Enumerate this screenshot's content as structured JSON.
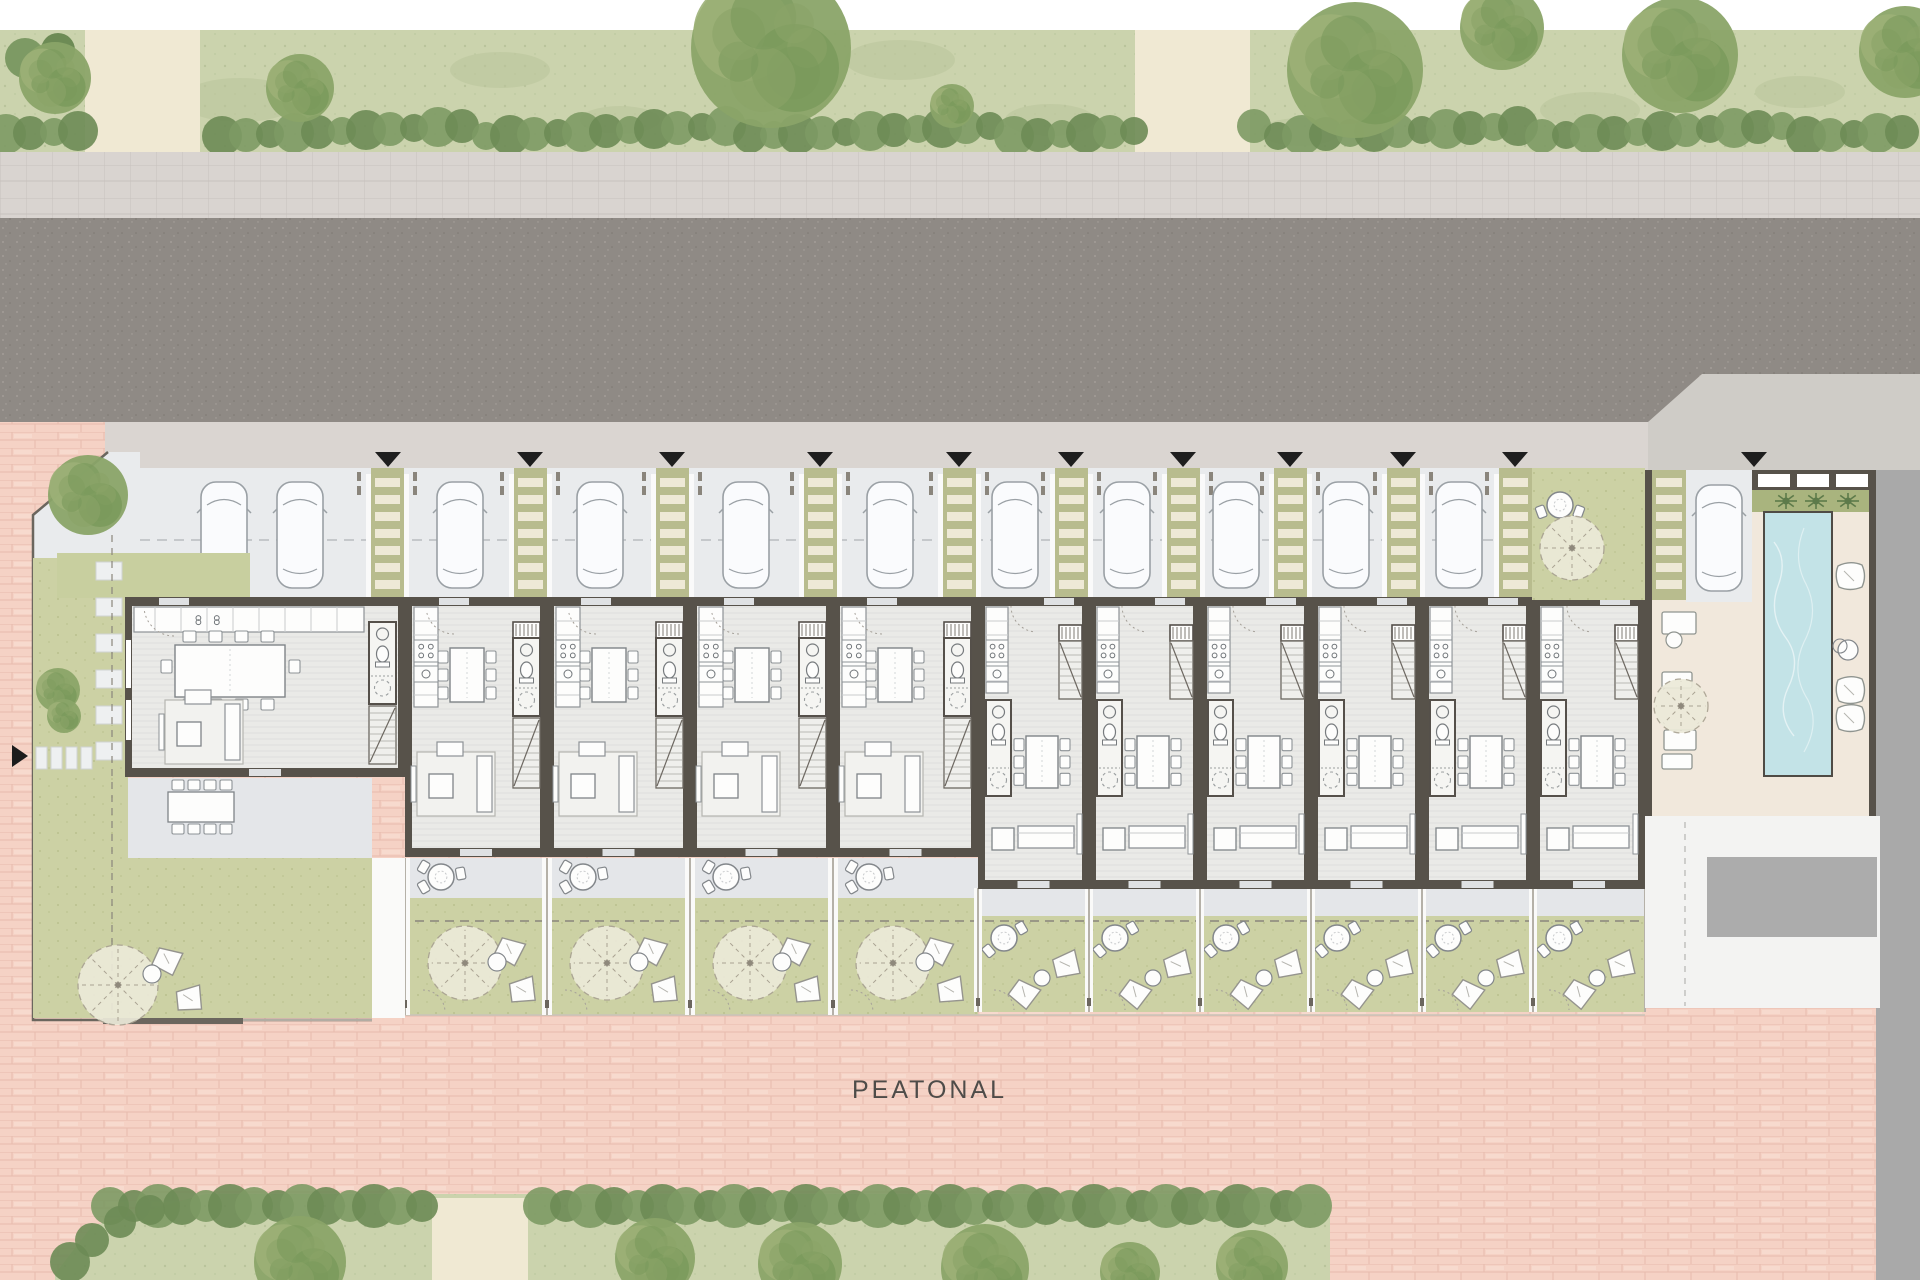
{
  "peatonal_label": "PEATONAL",
  "palette": {
    "white": "#ffffff",
    "lawn": "#cbd3ad",
    "lawn_dark": "#b9c49b",
    "hedge1": "#7d9a64",
    "hedge2": "#6d8b55",
    "tree1": "#8aa468",
    "tree2": "#7a9a5c",
    "tree3": "#9cb077",
    "beige_path": "#f0e9d3",
    "sidewalk": "#d9d4d0",
    "sidewalk_line": "#c8c2be",
    "road": "#8f8a85",
    "road_speck": "#a8a39d",
    "apron": "#cfccc7",
    "entry_band": "#dad5d1",
    "parking_bg": "#e9ebed",
    "pad_edge": "#c2c6ca",
    "strip_bg": "#b8bc8e",
    "strip_rung": "#eee9d6",
    "car_fill": "#fafbfd",
    "car_stroke": "#9aa0a5",
    "wall": "#57524a",
    "floor": "#eaeae7",
    "floor_line": "#dfdfdc",
    "fixture_stroke": "#8d9296",
    "fixture_fill": "#fdfdfc",
    "stair_fill": "#efefec",
    "terrace": "#e4e6e9",
    "garden_lawn": "#ccd1a4",
    "pink": "#f5d2c5",
    "pink_line": "#e6bbad",
    "pool": "#c3e3e7",
    "deck": "#f1e8dc",
    "planter": "#a9b47e",
    "palm": "#5d7a4a",
    "plaza": "#f3f3f2",
    "gray_block": "#acacac",
    "gray_band": "#a9a9a9",
    "label_color": "#4e4c49",
    "triangle": "#1e1e1e",
    "dash_line": "#8a857c"
  },
  "bands": {
    "lawn_top": [
      30,
      152
    ],
    "sidewalk": [
      152,
      218
    ],
    "road": [
      218,
      422
    ],
    "entry": [
      422,
      470
    ],
    "parking": [
      468,
      600
    ],
    "units_top": 597
  },
  "top_strip": {
    "beige_paths": [
      [
        85,
        115
      ],
      [
        1135,
        115
      ]
    ],
    "hedge_gaps": [
      [
        85,
        200
      ],
      [
        1135,
        1250
      ]
    ],
    "trees": [
      [
        771,
        48,
        80
      ],
      [
        300,
        88,
        34
      ],
      [
        55,
        78,
        36
      ],
      [
        1355,
        70,
        68
      ],
      [
        1502,
        28,
        42
      ],
      [
        1680,
        55,
        58
      ],
      [
        1905,
        52,
        46
      ],
      [
        952,
        106,
        22
      ]
    ],
    "grass_patches": [
      [
        240,
        100,
        60,
        22
      ],
      [
        500,
        70,
        50,
        18
      ],
      [
        620,
        120,
        40,
        14
      ],
      [
        900,
        60,
        55,
        20
      ],
      [
        1050,
        120,
        45,
        16
      ],
      [
        1300,
        132,
        40,
        14
      ],
      [
        1590,
        110,
        50,
        18
      ],
      [
        1800,
        92,
        45,
        16
      ]
    ]
  },
  "parking": {
    "x1": 140,
    "x2": 1645,
    "strips": [
      371,
      514,
      656,
      804,
      943,
      1055,
      1167,
      1274,
      1387,
      1499
    ],
    "strip_w": 33,
    "cars": [
      224,
      300,
      460,
      600,
      746,
      890,
      1015,
      1127,
      1236,
      1346,
      1459
    ],
    "car_cy": 535,
    "dash_y": 540,
    "front_garden": {
      "x": 1532,
      "w": 113
    }
  },
  "triangles": [
    388,
    530,
    672,
    820,
    959,
    1071,
    1183,
    1290,
    1403,
    1515,
    1754
  ],
  "units": {
    "top_y": 597,
    "list": [
      {
        "t": "C",
        "x": 125,
        "w": 280,
        "bottom": 768
      },
      {
        "t": "A",
        "x": 405,
        "w": 142,
        "bottom": 848
      },
      {
        "t": "A",
        "x": 547,
        "w": 143,
        "bottom": 848
      },
      {
        "t": "A",
        "x": 690,
        "w": 143,
        "bottom": 848
      },
      {
        "t": "A",
        "x": 833,
        "w": 145,
        "bottom": 848
      },
      {
        "t": "B",
        "x": 978,
        "w": 111,
        "bottom": 880
      },
      {
        "t": "B",
        "x": 1089,
        "w": 111,
        "bottom": 880
      },
      {
        "t": "B",
        "x": 1200,
        "w": 111,
        "bottom": 880
      },
      {
        "t": "B",
        "x": 1311,
        "w": 111,
        "bottom": 880
      },
      {
        "t": "B",
        "x": 1422,
        "w": 111,
        "bottom": 880
      },
      {
        "t": "B",
        "x": 1533,
        "w": 112,
        "bottom": 880
      }
    ]
  },
  "gardens": {
    "a_terrace": [
      858,
      898
    ],
    "a_lawn": [
      898,
      1015
    ],
    "b_walk": [
      888,
      916
    ],
    "b_lawn": [
      916,
      1012
    ],
    "dash_y": 921,
    "bottom_y": 1015
  },
  "left_corner": {
    "pad_poly": [
      [
        33,
        515
      ],
      [
        108,
        452
      ],
      [
        140,
        452
      ],
      [
        140,
        600
      ],
      [
        33,
        560
      ]
    ],
    "tree": [
      88,
      495,
      40
    ],
    "olive_patch": [
      57,
      553,
      193,
      45
    ],
    "lawn_col": [
      33,
      558,
      95,
      460
    ],
    "stones_col": {
      "x": 96,
      "y0": 562,
      "n": 6,
      "step": 36,
      "w": 26,
      "h": 18
    },
    "stones_row": {
      "y": 747,
      "x0": 36,
      "n": 4,
      "step": 15,
      "w": 11,
      "h": 22
    },
    "arrow": [
      12,
      745,
      28,
      756
    ],
    "terrace": [
      128,
      778,
      244,
      80
    ],
    "garden": [
      128,
      858,
      244,
      160
    ],
    "parasol": [
      118,
      985,
      40
    ],
    "small_trees": [
      [
        58,
        690,
        22
      ],
      [
        64,
        716,
        17
      ]
    ]
  },
  "amenity": {
    "x1": 1645,
    "x2": 1876,
    "wall_bottom": 816,
    "strip": [
      1652,
      470,
      34,
      130
    ],
    "pad": [
      1686,
      470,
      66,
      132
    ],
    "car_cx": 1719,
    "car_cy": 538,
    "window_wall": [
      1752,
      470,
      124,
      20
    ],
    "windows": [
      [
        1758,
        474,
        32,
        13
      ],
      [
        1797,
        474,
        32,
        13
      ],
      [
        1836,
        474,
        32,
        13
      ]
    ],
    "planter": [
      1752,
      490,
      120,
      22
    ],
    "palms": [
      [
        1786,
        501
      ],
      [
        1816,
        501
      ],
      [
        1848,
        501
      ]
    ],
    "pool": [
      1764,
      512,
      68,
      264
    ],
    "pillows_right": [
      [
        1836,
        562
      ],
      [
        1836,
        676
      ],
      [
        1836,
        704
      ]
    ],
    "side_table": [
      1848,
      650,
      10
    ],
    "loungers_left": [
      [
        1662,
        612,
        34,
        22
      ],
      [
        1662,
        672,
        30,
        16
      ],
      [
        1664,
        730,
        32,
        20
      ],
      [
        1662,
        754,
        30,
        15
      ]
    ],
    "parasol": [
      1681,
      706,
      27
    ],
    "plaza": [
      1645,
      816,
      235,
      192
    ],
    "gray_block": [
      1707,
      857,
      170,
      80
    ],
    "dash_x": 1685
  },
  "front_yard_13": {
    "parasol": [
      1572,
      548,
      32
    ],
    "table": [
      1560,
      505,
      13
    ]
  },
  "bottom_band": {
    "poly": [
      [
        55,
        1274
      ],
      [
        92,
        1226
      ],
      [
        205,
        1194
      ],
      [
        1330,
        1194
      ],
      [
        1330,
        1280
      ],
      [
        55,
        1280
      ]
    ],
    "beige_gap": [
      432,
      1198,
      96,
      82
    ],
    "hedge_top_y": 1200,
    "hedge_x": [
      110,
      1330
    ],
    "trees": [
      [
        300,
        1262,
        46
      ],
      [
        655,
        1258,
        40
      ],
      [
        800,
        1264,
        42
      ],
      [
        985,
        1268,
        44
      ],
      [
        1130,
        1272,
        30
      ],
      [
        1252,
        1266,
        36
      ]
    ]
  },
  "pink_area": {
    "x": 0,
    "y": 405,
    "w": 1880,
    "h": 875
  },
  "gray_band": [
    1876,
    470,
    44,
    810
  ]
}
